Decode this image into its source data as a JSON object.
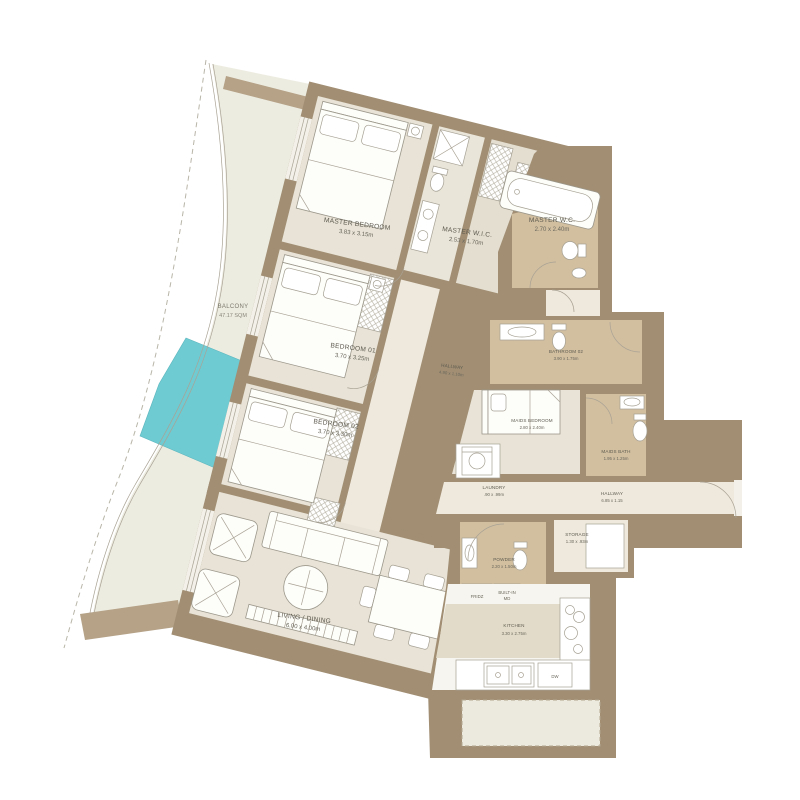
{
  "plan": {
    "balcony": {
      "name": "BALCONY",
      "dims": "47.17 SQM"
    },
    "master_bedroom": {
      "name": "MASTER BEDROOM",
      "dims": "3.83 x 3.15m"
    },
    "master_wic": {
      "name": "MASTER W.I.C.",
      "dims": "2.53 x 1.70m"
    },
    "master_wc": {
      "name": "MASTER W.C.",
      "dims": "2.70 x 2.40m"
    },
    "bedroom_01": {
      "name": "BEDROOM 01",
      "dims": "3.70 x 3.25m"
    },
    "bedroom_02": {
      "name": "BEDROOM 02",
      "dims": "3.70 x 3.30m"
    },
    "hallway_1": {
      "name": "HALLWAY",
      "dims": "4.90 x 1.10m"
    },
    "bathroom_02": {
      "name": "BATHROOM 02",
      "dims": "3.90 x 1.75m"
    },
    "maids_bedroom": {
      "name": "MAIDS BEDROOM",
      "dims": "2.80 x 2.40m"
    },
    "maids_bath": {
      "name": "MAIDS BATH",
      "dims": "1.95 x 1.25m"
    },
    "laundry": {
      "name": "LAUNDRY",
      "dims": ".90 x .99m"
    },
    "hallway_2": {
      "name": "HALLWAY",
      "dims": "6.85 x 1.15"
    },
    "storage": {
      "name": "STORAGE",
      "dims": "1.30 x .93m"
    },
    "powder": {
      "name": "POWDER",
      "dims": "2.20 x 1.50m"
    },
    "fridge": {
      "name": "FRIDZ"
    },
    "built_in": {
      "name": "BUILT-IN",
      "name2": "MD"
    },
    "kitchen": {
      "name": "KITCHEN",
      "dims": "3.30 x 2.75m"
    },
    "dishwasher": {
      "name": "DW"
    },
    "living_dining": {
      "name": "LIVING / DINING",
      "dims": "6.00 x 4.00m"
    }
  },
  "colors": {
    "wall": "#a18e73",
    "wall_light": "#b5a287",
    "floor": "#e8e3d6",
    "floor_wet": "#d2bfa0",
    "floor_hall": "#efe9dd",
    "pool": "#6fcbd2",
    "balcony": "#edece1"
  }
}
